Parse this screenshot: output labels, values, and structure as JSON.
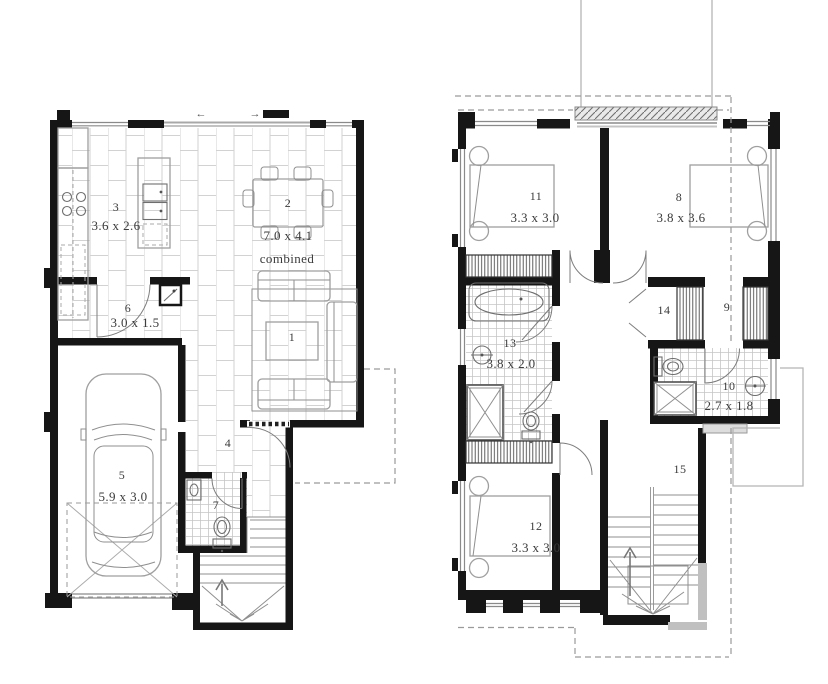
{
  "colors": {
    "wall": "#161616",
    "furniture_line": "#8f8f8f",
    "fixture_line": "#6e6e6e",
    "tile_line": "#d2d2d2",
    "dashed_line": "#9a9a9a",
    "label_text": "#3b3b3b",
    "balcony_fill": "#e9e9e9"
  },
  "ground_floor": {
    "rooms": {
      "living": {
        "number": "1",
        "dims": ""
      },
      "dining": {
        "number": "2",
        "dims": "7.0 x 4.1",
        "note": "combined"
      },
      "kitchen": {
        "number": "3",
        "dims": "3.6 x 2.6"
      },
      "hall": {
        "number": "4",
        "dims": ""
      },
      "garage": {
        "number": "5",
        "dims": "5.9 x 3.0"
      },
      "entry": {
        "number": "6",
        "dims": "3.0 x 1.5"
      },
      "wc": {
        "number": "7",
        "dims": ""
      }
    },
    "sliding_door_arrows": {
      "left": "←",
      "right": "→"
    }
  },
  "upper_floor": {
    "rooms": {
      "bed_main": {
        "number": "8",
        "dims": "3.8 x 3.6"
      },
      "robe_hall": {
        "number": "9",
        "dims": ""
      },
      "ensuite": {
        "number": "10",
        "dims": "2.7 x 1.8"
      },
      "bed_two": {
        "number": "11",
        "dims": "3.3 x 3.0"
      },
      "bed_three": {
        "number": "12",
        "dims": "3.3 x 3.0"
      },
      "bathroom": {
        "number": "13",
        "dims": "3.8 x 2.0"
      },
      "linen": {
        "number": "14",
        "dims": ""
      },
      "stairs": {
        "number": "15",
        "dims": ""
      }
    }
  }
}
